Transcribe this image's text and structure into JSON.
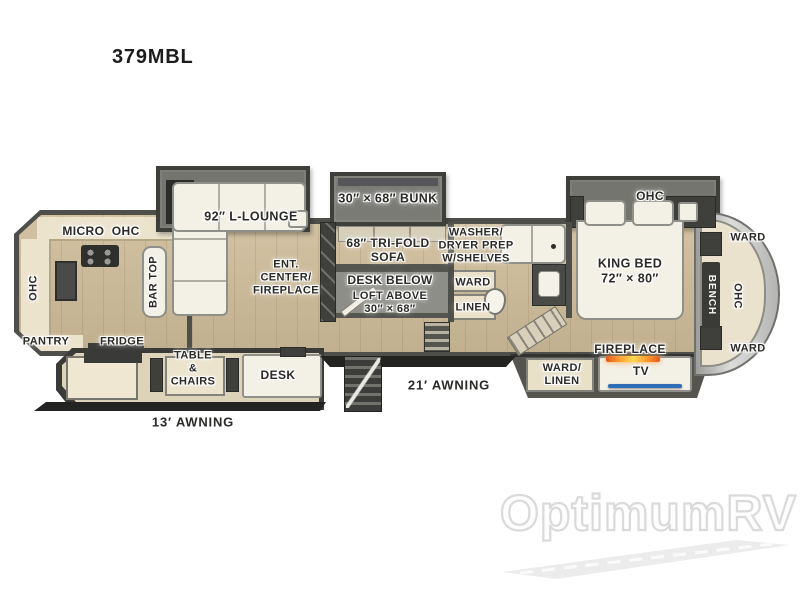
{
  "title": "379MBL",
  "watermark": {
    "brand": "OptimumRV"
  },
  "colors": {
    "wall": "#4e4e4b",
    "floor": "#cdbb98",
    "slide_gray": "#75756f",
    "furniture_white": "#f3f0e6",
    "cabinet_cream": "#e9e0c8",
    "dark_cabinet": "#3f3f3c",
    "flame_orange": "#f59b2c",
    "tv_blue": "#2e6db8",
    "watermark_gray": "#dadada"
  },
  "labels": {
    "micro_ohc": "MICRO  OHC",
    "ohc_kitchen": "OHC",
    "pantry": "PANTRY",
    "fridge": "FRIDGE",
    "bar_top": "BAR TOP",
    "l_lounge": "92″ L-LOUNGE",
    "ent_center": "ENT.\nCENTER/\nFIREPLACE",
    "table_chairs": "TABLE\n&\nCHAIRS",
    "desk": "DESK",
    "awning_13": "13′ AWNING",
    "bunk": "30″ × 68″ BUNK",
    "trifold_sofa": "68″ TRI-FOLD\nSOFA",
    "washer_dryer": "WASHER/\nDRYER PREP\nW/SHELVES",
    "desk_below": "DESK BELOW",
    "loft_above": "LOFT ABOVE\n30″ × 68″",
    "ward_mid": "WARD",
    "linen": "LINEN",
    "awning_21": "21′ AWNING",
    "ohc_bedroom": "OHC",
    "king_bed": "KING BED\n72″ × 80″",
    "fireplace": "FIREPLACE",
    "ward_linen": "WARD/\nLINEN",
    "tv": "TV",
    "ward_front_top": "WARD",
    "bench": "BENCH",
    "ohc_front": "OHC",
    "ward_front_bottom": "WARD"
  }
}
